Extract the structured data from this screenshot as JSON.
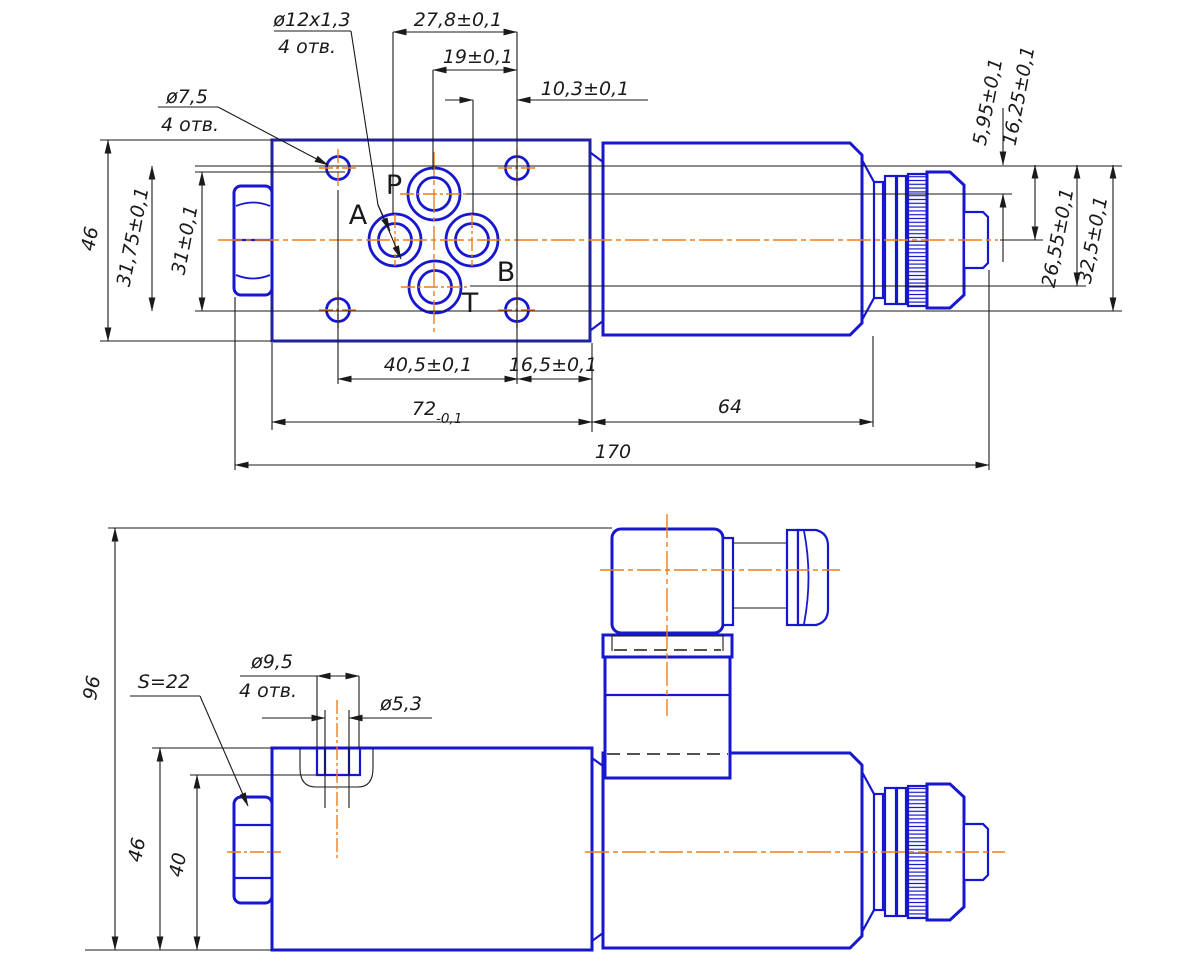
{
  "colors": {
    "part-blue": "#1717cf",
    "plate-navy": "#22229a",
    "centerline-orange": "#ef7d1a",
    "line-black": "#1a1a1a"
  },
  "top_view": {
    "ports": {
      "p": "P",
      "a": "A",
      "b": "B",
      "t": "T"
    },
    "callout_thread": {
      "spec": "ø12x1,3",
      "qty": "4 отв."
    },
    "callout_hole": {
      "spec": "ø7,5",
      "qty": "4 отв."
    },
    "dims": {
      "w278": "27,8±0,1",
      "w19": "19±0,1",
      "w103": "10,3±0,1",
      "h46": "46",
      "h3175": "31,75±0,1",
      "h31": "31±0,1",
      "w405": "40,5±0,1",
      "w165": "16,5±0,1",
      "w72": "72",
      "w72_tol": "-0,1",
      "w64": "64",
      "w170": "170",
      "r595": "5,95±0,1",
      "r1625": "16,25±0,1",
      "r2655": "26,55±0,1",
      "r325": "32,5±0,1"
    }
  },
  "bottom_view": {
    "callout_wrench": "S=22",
    "callout_cbore": {
      "spec": "ø9,5",
      "qty": "4 отв."
    },
    "callout_hole": "ø5,3",
    "dims": {
      "h96": "96",
      "h46": "46",
      "h40": "40"
    }
  }
}
